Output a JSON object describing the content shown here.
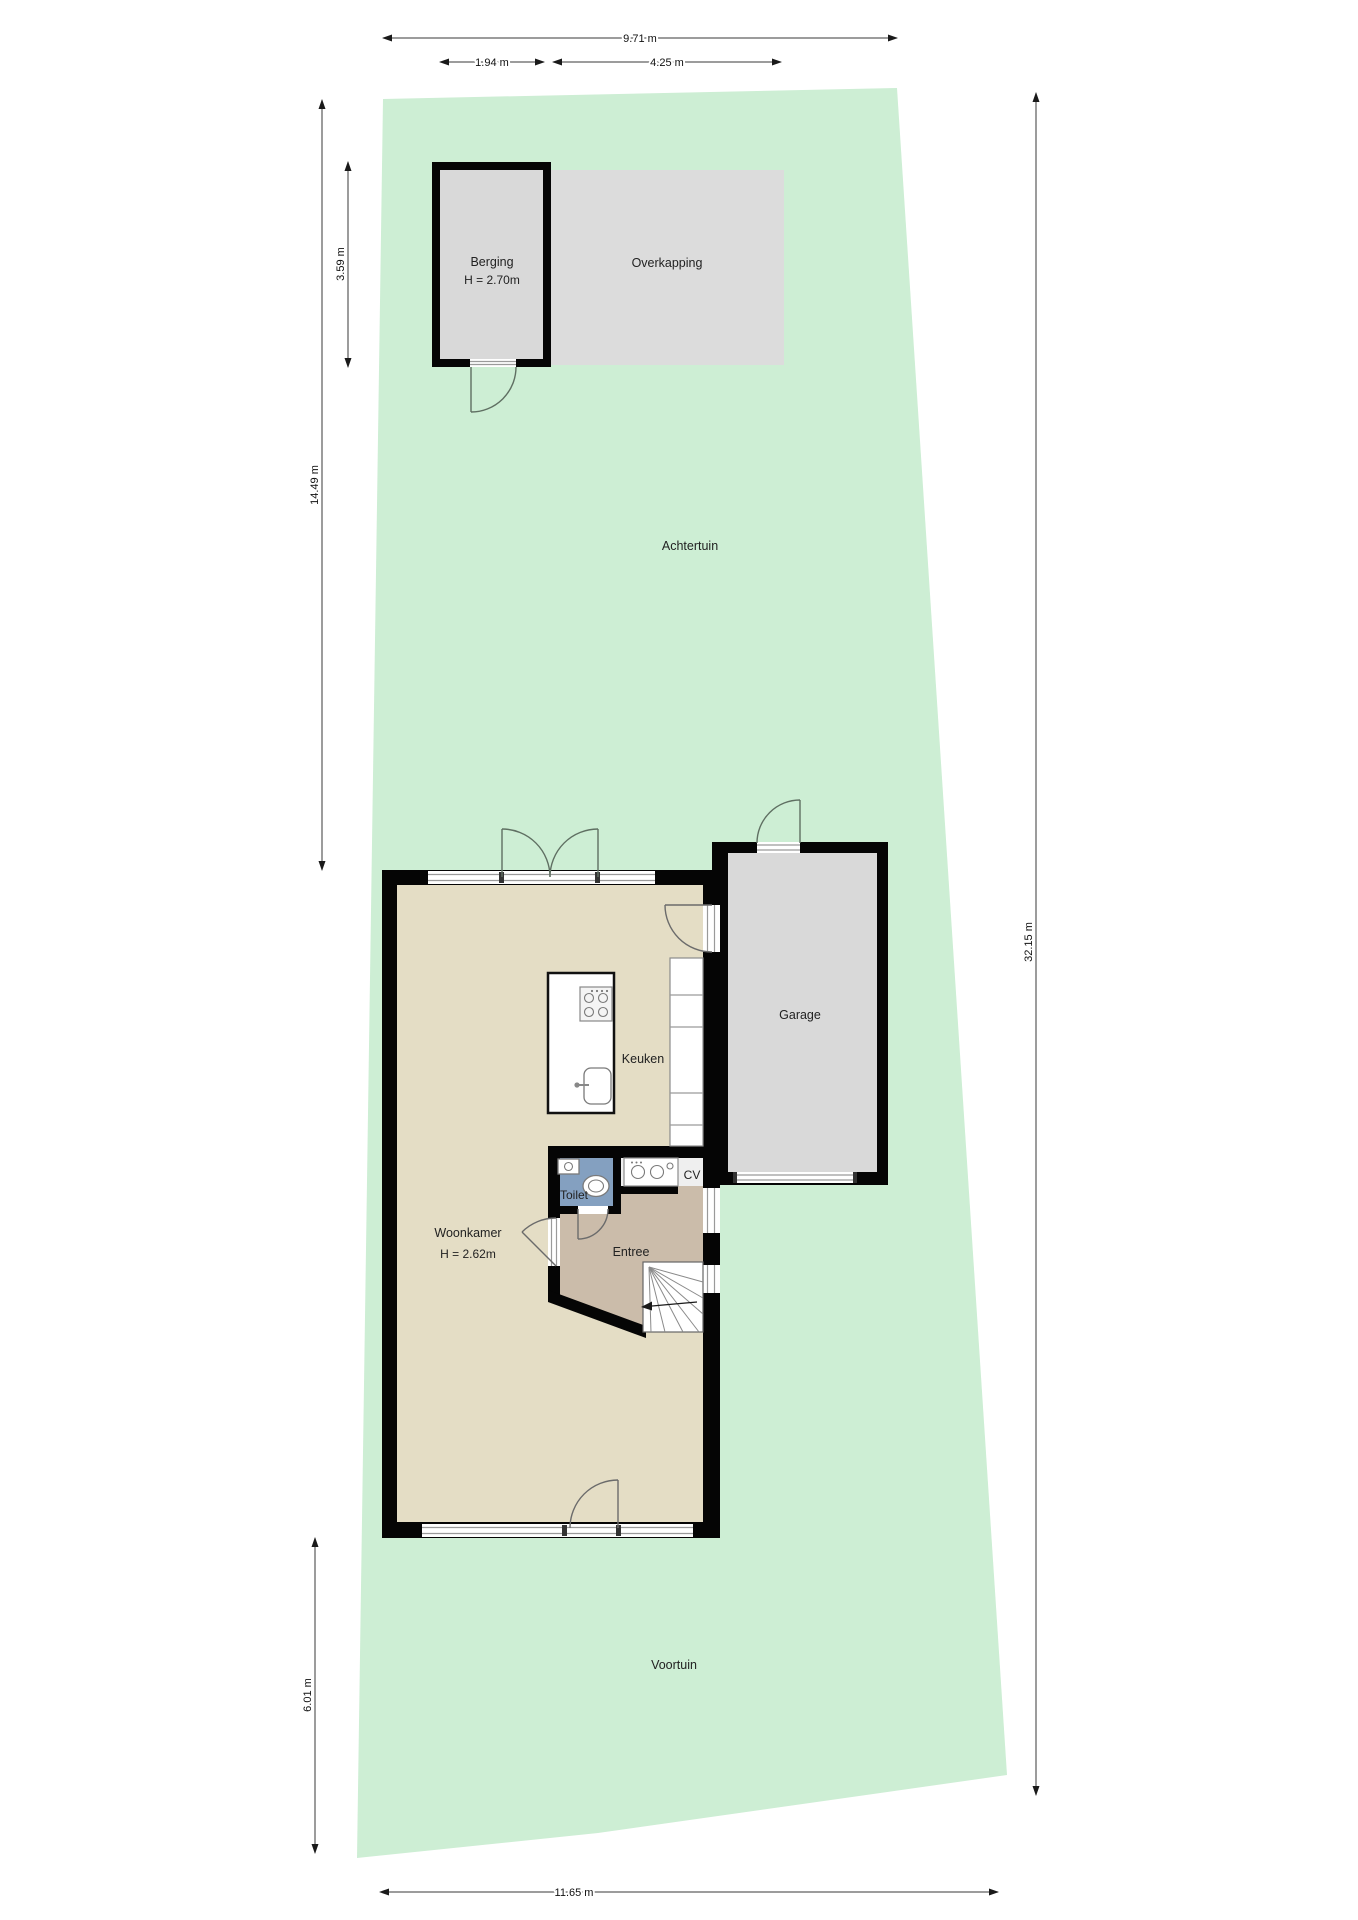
{
  "rooms": {
    "achtertuin": {
      "label": "Achtertuin"
    },
    "voortuin": {
      "label": "Voortuin"
    },
    "berging": {
      "label": "Berging",
      "height_label": "H = 2.70m"
    },
    "overkapping": {
      "label": "Overkapping"
    },
    "garage": {
      "label": "Garage"
    },
    "keuken": {
      "label": "Keuken"
    },
    "woonkamer": {
      "label": "Woonkamer",
      "height_label": "H = 2.62m"
    },
    "toilet": {
      "label": "Toilet"
    },
    "cv": {
      "label": "CV"
    },
    "entree": {
      "label": "Entree"
    }
  },
  "dimensions": {
    "plot_width_top": "9.71 m",
    "berging_width": "1.94 m",
    "overkapping_width": "4.25 m",
    "berging_depth": "3.59 m",
    "achtertuin_depth": "14.49 m",
    "voortuin_depth": "6.01 m",
    "plot_depth_right": "32.15 m",
    "plot_width_bottom": "11.65 m"
  },
  "colors": {
    "garden": "#cdeed4",
    "floor_main": "#e4ddc5",
    "floor_entree": "#cbbcaa",
    "floor_toilet": "#84a0c0",
    "floor_garage": "#d9d9d9",
    "floor_overkapping": "#dcdcdc",
    "floor_cv": "#efefef",
    "wall": "#050505"
  },
  "icons": {
    "stove": "4-burner cooktop (top view)",
    "kitchen_sink": "single sink with faucet",
    "wc": "toilet bowl (top view)",
    "washbasin": "small hand basin",
    "cv_units": "boiler / washer circles",
    "stairs_arrow": "stair direction arrow"
  }
}
